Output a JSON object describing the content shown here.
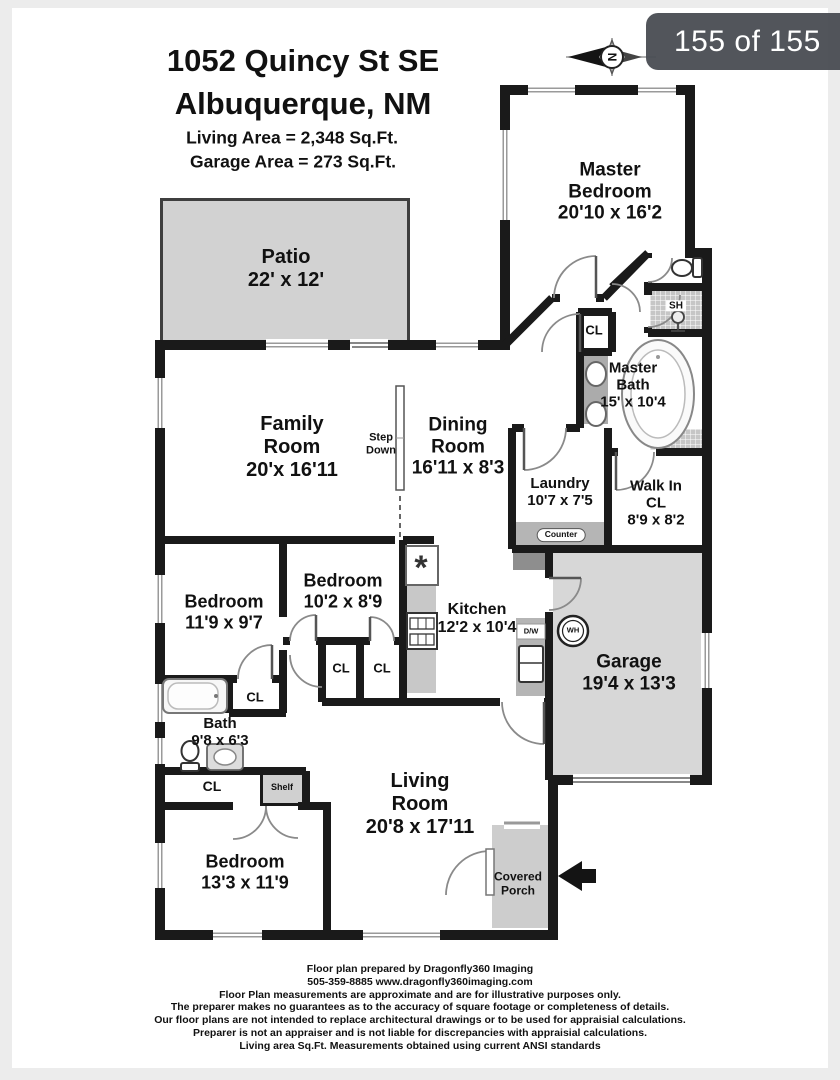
{
  "viewer": {
    "counter_badge": "155 of 155"
  },
  "compass": {
    "letter": "N"
  },
  "header": {
    "address_line1": "1052 Quincy St SE",
    "address_line2": "Albuquerque, NM",
    "living_area": "Living Area = 2,348 Sq.Ft.",
    "garage_area": "Garage Area = 273 Sq.Ft."
  },
  "rooms": {
    "patio": {
      "name": "Patio",
      "dims": "22' x 12'"
    },
    "master_bedroom": {
      "name": "Master Bedroom",
      "dims": "20'10 x 16'2"
    },
    "family_room": {
      "name": "Family Room",
      "dims": "20'x 16'11"
    },
    "dining_room": {
      "name": "Dining Room",
      "dims": "16'11 x 8'3"
    },
    "master_bath": {
      "name": "Master Bath",
      "dims": "15' x 10'4"
    },
    "laundry": {
      "name": "Laundry",
      "dims": "10'7 x 7'5"
    },
    "walk_in_closet": {
      "name": "Walk In CL",
      "dims": "8'9 x 8'2"
    },
    "bedroom_mid_left": {
      "name": "Bedroom",
      "dims": "11'9 x 9'7"
    },
    "bedroom_mid": {
      "name": "Bedroom",
      "dims": "10'2 x 8'9"
    },
    "kitchen": {
      "name": "Kitchen",
      "dims": "12'2 x 10'4"
    },
    "garage": {
      "name": "Garage",
      "dims": "19'4 x 13'3"
    },
    "bath": {
      "name": "Bath",
      "dims": "9'8 x 6'3"
    },
    "living_room": {
      "name": "Living Room",
      "dims": "20'8 x 17'11"
    },
    "bedroom_front": {
      "name": "Bedroom",
      "dims": "13'3 x 11'9"
    },
    "covered_porch": {
      "name": "Covered Porch"
    }
  },
  "labels": {
    "step_down": "Step Down",
    "closet": "CL",
    "counter": "Counter",
    "shelf": "Shelf",
    "shower": "SH",
    "water_heater": "WH",
    "dishwasher": "D/W",
    "sink_symbol": "*"
  },
  "footer": {
    "lines": [
      "Floor plan prepared by Dragonfly360 Imaging",
      "505-359-8885 www.dragonfly360imaging.com",
      "Floor Plan measurements are approximate and are for illustrative purposes only.",
      "The preparer makes no guarantees as to the accuracy of square footage or completeness of details.",
      "Our floor plans are not intended to replace architectural drawings or to be used for appraisial calculations.",
      "Preparer is not an appraiser and is not liable for discrepancies with appraisial calculations.",
      "Living area Sq.Ft. Measurements obtained using current ANSI standards"
    ]
  },
  "colors": {
    "badge_bg": "#4a4d52",
    "wall": "#1a1a1a",
    "area_fill": "#d3d3d3"
  }
}
